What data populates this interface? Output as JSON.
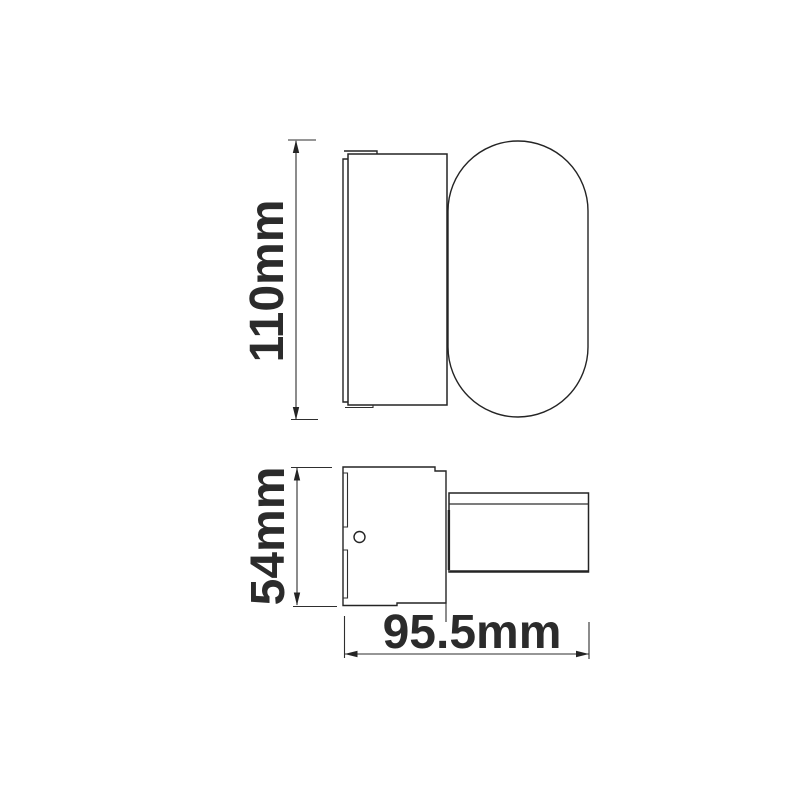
{
  "drawing": {
    "kind": "technical-dimension-drawing",
    "colors": {
      "background": "#ffffff",
      "line": "#242424",
      "text": "#2b2b2b"
    },
    "dimensions": {
      "side_view_height": "110mm",
      "plan_view_width": "54mm",
      "plan_view_depth": "95.5mm"
    }
  }
}
